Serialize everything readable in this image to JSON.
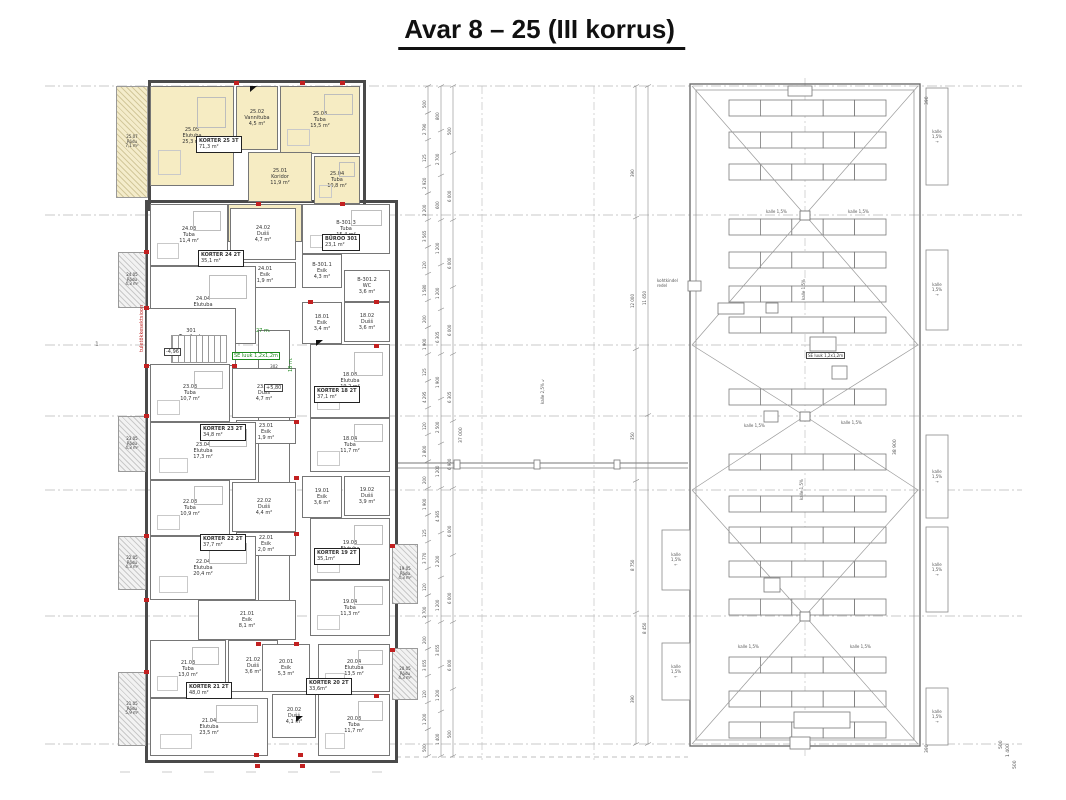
{
  "title": "Avar 8 – 25  (III korrus)",
  "floor_plan": {
    "highlight_color": "#f6ecc3",
    "axis_label": "1",
    "rooms": [
      {
        "nr": "25.07",
        "name": "Rõdu",
        "area": "7,1 m²",
        "x": 116,
        "y": 86,
        "w": 32,
        "h": 112,
        "t": "balcony",
        "fill": "y"
      },
      {
        "nr": "25.05",
        "name": "Elutuba",
        "area": "25,3 m²",
        "x": 150,
        "y": 86,
        "w": 84,
        "h": 100,
        "fill": "y"
      },
      {
        "nr": "25.02",
        "name": "Vannituba",
        "area": "4,5 m²",
        "x": 236,
        "y": 86,
        "w": 42,
        "h": 64,
        "fill": "y"
      },
      {
        "nr": "25.03",
        "name": "Tuba",
        "area": "15,5 m²",
        "x": 280,
        "y": 86,
        "w": 80,
        "h": 68,
        "fill": "y"
      },
      {
        "nr": "25.01",
        "name": "Koridor",
        "area": "11,9 m²",
        "x": 248,
        "y": 152,
        "w": 64,
        "h": 50,
        "fill": "y"
      },
      {
        "nr": "25.04",
        "name": "Tuba",
        "area": "10,8 m²",
        "x": 314,
        "y": 156,
        "w": 46,
        "h": 48,
        "fill": "y"
      },
      {
        "nr": "25.06",
        "name": "Majandusruum",
        "area": "3,3 m²",
        "x": 228,
        "y": 204,
        "w": 74,
        "h": 38,
        "fill": "y"
      },
      {
        "nr": "24.05",
        "name": "Rõdu",
        "area": "4,3 m²",
        "x": 118,
        "y": 252,
        "w": 28,
        "h": 56,
        "t": "balcony"
      },
      {
        "nr": "24.03",
        "name": "Tuba",
        "area": "11,4 m²",
        "x": 150,
        "y": 204,
        "w": 78,
        "h": 62
      },
      {
        "nr": "24.02",
        "name": "Dušš",
        "area": "4,7 m²",
        "x": 230,
        "y": 208,
        "w": 66,
        "h": 52
      },
      {
        "nr": "24.01",
        "name": "Esik",
        "area": "1,9 m²",
        "x": 234,
        "y": 262,
        "w": 62,
        "h": 26
      },
      {
        "nr": "24.04",
        "name": "Elutuba",
        "area": "17,2 m²",
        "x": 150,
        "y": 266,
        "w": 106,
        "h": 78
      },
      {
        "nr": "B-301.3",
        "name": "Tuba",
        "area": "15,4 m²",
        "x": 302,
        "y": 204,
        "w": 88,
        "h": 50
      },
      {
        "nr": "B-301.1",
        "name": "Esik",
        "area": "4,3 m²",
        "x": 302,
        "y": 254,
        "w": 40,
        "h": 34
      },
      {
        "nr": "B-301.2",
        "name": "WC",
        "area": "3,6 m²",
        "x": 344,
        "y": 270,
        "w": 46,
        "h": 32
      },
      {
        "nr": "301",
        "name": "Trepikoda",
        "area": "17,3 m²",
        "x": 146,
        "y": 308,
        "w": 90,
        "h": 58,
        "t": "stair"
      },
      {
        "nr": "302",
        "name": "Koridor",
        "area": "30,2 m²",
        "x": 258,
        "y": 330,
        "w": 32,
        "h": 310,
        "t": "corr"
      },
      {
        "nr": "18.01",
        "name": "Esik",
        "area": "3,4 m²",
        "x": 302,
        "y": 302,
        "w": 40,
        "h": 42
      },
      {
        "nr": "18.02",
        "name": "Dušš",
        "area": "3,6 m²",
        "x": 344,
        "y": 302,
        "w": 46,
        "h": 40
      },
      {
        "nr": "18.03",
        "name": "Elutuba",
        "area": "19,2 m²",
        "x": 310,
        "y": 344,
        "w": 80,
        "h": 74
      },
      {
        "nr": "18.04",
        "name": "Tuba",
        "area": "11,7 m²",
        "x": 310,
        "y": 418,
        "w": 80,
        "h": 54
      },
      {
        "nr": "19.01",
        "name": "Esik",
        "area": "3,6 m²",
        "x": 302,
        "y": 476,
        "w": 40,
        "h": 42
      },
      {
        "nr": "19.02",
        "name": "Dušš",
        "area": "3,9 m²",
        "x": 344,
        "y": 476,
        "w": 46,
        "h": 40
      },
      {
        "nr": "19.03",
        "name": "Elutuba",
        "area": "16,3 m²",
        "x": 310,
        "y": 518,
        "w": 80,
        "h": 62
      },
      {
        "nr": "19.04",
        "name": "Tuba",
        "area": "11,3 m²",
        "x": 310,
        "y": 580,
        "w": 80,
        "h": 56
      },
      {
        "nr": "19.05",
        "name": "Rõdu",
        "area": "4,3 m²",
        "x": 392,
        "y": 544,
        "w": 26,
        "h": 60,
        "t": "balcony"
      },
      {
        "nr": "23.03",
        "name": "Tuba",
        "area": "10,7 m²",
        "x": 150,
        "y": 364,
        "w": 80,
        "h": 58
      },
      {
        "nr": "23.02",
        "name": "Dušš",
        "area": "4,7 m²",
        "x": 232,
        "y": 368,
        "w": 64,
        "h": 50
      },
      {
        "nr": "23.01",
        "name": "Esik",
        "area": "1,9 m²",
        "x": 236,
        "y": 420,
        "w": 60,
        "h": 24
      },
      {
        "nr": "23.04",
        "name": "Elutuba",
        "area": "17,3 m²",
        "x": 150,
        "y": 422,
        "w": 106,
        "h": 58
      },
      {
        "nr": "23.05",
        "name": "Rõdu",
        "area": "4,3 m²",
        "x": 118,
        "y": 416,
        "w": 28,
        "h": 56,
        "t": "balcony"
      },
      {
        "nr": "22.03",
        "name": "Tuba",
        "area": "10,9 m²",
        "x": 150,
        "y": 480,
        "w": 80,
        "h": 56
      },
      {
        "nr": "22.02",
        "name": "Dušš",
        "area": "4,4 m²",
        "x": 232,
        "y": 482,
        "w": 64,
        "h": 50
      },
      {
        "nr": "22.01",
        "name": "Esik",
        "area": "2,0 m²",
        "x": 236,
        "y": 532,
        "w": 60,
        "h": 24
      },
      {
        "nr": "22.04",
        "name": "Elutuba",
        "area": "20,4 m²",
        "x": 150,
        "y": 536,
        "w": 106,
        "h": 64
      },
      {
        "nr": "22.05",
        "name": "Rõdu",
        "area": "4,3 m²",
        "x": 118,
        "y": 536,
        "w": 28,
        "h": 54,
        "t": "balcony"
      },
      {
        "nr": "21.01",
        "name": "Esik",
        "area": "8,1 m²",
        "x": 198,
        "y": 600,
        "w": 98,
        "h": 40
      },
      {
        "nr": "21.03",
        "name": "Tuba",
        "area": "13,0 m²",
        "x": 150,
        "y": 640,
        "w": 76,
        "h": 58
      },
      {
        "nr": "21.02",
        "name": "Dušš",
        "area": "3,6 m²",
        "x": 228,
        "y": 640,
        "w": 50,
        "h": 52
      },
      {
        "nr": "21.04",
        "name": "Elutuba",
        "area": "23,5 m²",
        "x": 150,
        "y": 698,
        "w": 118,
        "h": 58
      },
      {
        "nr": "21.05",
        "name": "Rõdu",
        "area": "5,9 m²",
        "x": 118,
        "y": 672,
        "w": 28,
        "h": 74,
        "t": "balcony"
      },
      {
        "nr": "20.01",
        "name": "Esik",
        "area": "5,3 m²",
        "x": 262,
        "y": 644,
        "w": 48,
        "h": 48
      },
      {
        "nr": "20.04",
        "name": "Elutuba",
        "area": "13,5 m²",
        "x": 318,
        "y": 644,
        "w": 72,
        "h": 48
      },
      {
        "nr": "20.02",
        "name": "Dušš",
        "area": "4,1 m²",
        "x": 272,
        "y": 694,
        "w": 44,
        "h": 44
      },
      {
        "nr": "20.03",
        "name": "Tuba",
        "area": "11,7 m²",
        "x": 318,
        "y": 694,
        "w": 72,
        "h": 62
      },
      {
        "nr": "20.05",
        "name": "Rõdu",
        "area": "4,3 m²",
        "x": 392,
        "y": 648,
        "w": 26,
        "h": 52,
        "t": "balcony"
      }
    ],
    "apartment_labels": [
      {
        "name": "KORTER 25 3T",
        "area": "71,3 m²",
        "x": 196,
        "y": 136
      },
      {
        "name": "KORTER 24 2T",
        "area": "35,1 m²",
        "x": 198,
        "y": 250
      },
      {
        "name": "BÜROO 301",
        "area": "23,1 m²",
        "x": 322,
        "y": 234
      },
      {
        "name": "KORTER 18 2T",
        "area": "37,1 m²",
        "x": 314,
        "y": 386
      },
      {
        "name": "KORTER 19 2T",
        "area": "35,1m²",
        "x": 314,
        "y": 548
      },
      {
        "name": "KORTER 23 2T",
        "area": "34,8 m²",
        "x": 200,
        "y": 424
      },
      {
        "name": "KORTER 22 2T",
        "area": "37,7 m²",
        "x": 200,
        "y": 534
      },
      {
        "name": "KORTER 21 2T",
        "area": "48,0 m²",
        "x": 186,
        "y": 682
      },
      {
        "name": "KORTER 20 2T",
        "area": "33,6m²",
        "x": 306,
        "y": 678
      }
    ],
    "notes": [
      {
        "text": "+5,80",
        "x": 264,
        "y": 384,
        "boxed": true
      },
      {
        "text": "-4,96",
        "x": 164,
        "y": 348,
        "boxed": true
      },
      {
        "text": "SE luuk 1,2x1,2m",
        "x": 232,
        "y": 352,
        "green": true,
        "boxed": true
      },
      {
        "text": "27 m.",
        "x": 256,
        "y": 328,
        "green": true
      },
      {
        "text": "18 m.",
        "x": 288,
        "y": 372,
        "green": true,
        "rot": true
      },
      {
        "text": "tuletõkkesektsioon",
        "x": 139,
        "y": 352,
        "red": true,
        "rot": true
      }
    ]
  },
  "roof_plan": {
    "panel_row_y": [
      100,
      132,
      164,
      219,
      252,
      286,
      317,
      389,
      454,
      496,
      527,
      561,
      599,
      657,
      691,
      722
    ],
    "sections": [
      {
        "y1": 86,
        "y2": 345,
        "cy": 215
      },
      {
        "y1": 345,
        "y2": 490,
        "cy": 416
      },
      {
        "y1": 490,
        "y2": 744,
        "cy": 616
      }
    ],
    "slope_labels": [
      {
        "text": "kalle 1,5%",
        "x": 766,
        "y": 209
      },
      {
        "text": "kalle 1,5%",
        "x": 848,
        "y": 209
      },
      {
        "text": "kalle 1,5%",
        "x": 744,
        "y": 423
      },
      {
        "text": "kalle 1,5%",
        "x": 841,
        "y": 420
      },
      {
        "text": "kalle 1,5%",
        "x": 738,
        "y": 644
      },
      {
        "text": "kalle 1,5%",
        "x": 850,
        "y": 644
      },
      {
        "text": "kalle 1,5%",
        "x": 801,
        "y": 300,
        "rot": true
      },
      {
        "text": "kalle 1,5%",
        "x": 799,
        "y": 500,
        "rot": true
      }
    ],
    "bridge_slope": {
      "text": "kalle 2,5%",
      "x": 540,
      "y": 404,
      "rot": true
    },
    "se_luuk": {
      "text": "SE luuk 1,2x1,2m",
      "x": 806,
      "y": 352
    },
    "ladder_label": {
      "text": "kohtkindel redel",
      "x": 657,
      "y": 278
    },
    "side_boxes": [
      {
        "x": 926,
        "y": 88,
        "w": 22,
        "h": 97,
        "label": "kalle 1,5%",
        "arrow": "→"
      },
      {
        "x": 926,
        "y": 250,
        "w": 22,
        "h": 80,
        "label": "kalle 1,5%",
        "arrow": "→"
      },
      {
        "x": 926,
        "y": 435,
        "w": 22,
        "h": 83,
        "label": "kalle 1,5%",
        "arrow": "→"
      },
      {
        "x": 926,
        "y": 527,
        "w": 22,
        "h": 85,
        "label": "kalle 1,5%",
        "arrow": "→"
      },
      {
        "x": 926,
        "y": 688,
        "w": 22,
        "h": 57,
        "label": "kalle 1,5%",
        "arrow": "→"
      },
      {
        "x": 662,
        "y": 530,
        "w": 28,
        "h": 60,
        "label": "kalle 1,5%",
        "arrow": "←"
      },
      {
        "x": 662,
        "y": 643,
        "w": 28,
        "h": 57,
        "label": "kalle 1,5%",
        "arrow": "←"
      }
    ]
  },
  "dimensions": {
    "chains": [
      {
        "x": 428,
        "y1": 86,
        "y2": 756,
        "values": [
          "500",
          "2 790",
          "125",
          "2 920",
          "2 200",
          "3 565",
          "120",
          "1 580",
          "200",
          "1 900",
          "125",
          "4 295",
          "120",
          "2 800",
          "200",
          "1 900",
          "125",
          "3 770",
          "120",
          "2 700",
          "200",
          "3 055",
          "120",
          "1 200",
          "500"
        ]
      },
      {
        "x": 441,
        "y1": 86,
        "y2": 756,
        "values": [
          "800",
          "2 700",
          "600",
          "1 200",
          "1 200",
          "6 305",
          "1 900",
          "2 500",
          "1 200",
          "4 365",
          "2 200",
          "1 200",
          "3 055",
          "1 200",
          "1 400"
        ]
      },
      {
        "x": 453,
        "y1": 86,
        "y2": 756,
        "values": [
          "500",
          "6 000",
          "6 000",
          "6 000",
          "6 305",
          "6 900",
          "6 000",
          "6 000",
          "6 000",
          "500"
        ]
      },
      {
        "x": 636,
        "y1": 86,
        "y2": 744,
        "values": [
          "390",
          "12 000",
          "350",
          "8 750",
          "390"
        ]
      },
      {
        "x": 648,
        "y1": 86,
        "y2": 744,
        "values": [
          "11 650",
          "8 450"
        ]
      }
    ],
    "singles": [
      {
        "text": "37 000",
        "x": 464,
        "y": 438
      },
      {
        "text": "38 900",
        "x": 898,
        "y": 450
      },
      {
        "text": "390",
        "x": 930,
        "y": 100
      },
      {
        "text": "390",
        "x": 930,
        "y": 748
      },
      {
        "text": "500",
        "x": 1004,
        "y": 744
      },
      {
        "text": "1 400",
        "x": 1011,
        "y": 752
      },
      {
        "text": "500",
        "x": 1018,
        "y": 764
      }
    ]
  }
}
